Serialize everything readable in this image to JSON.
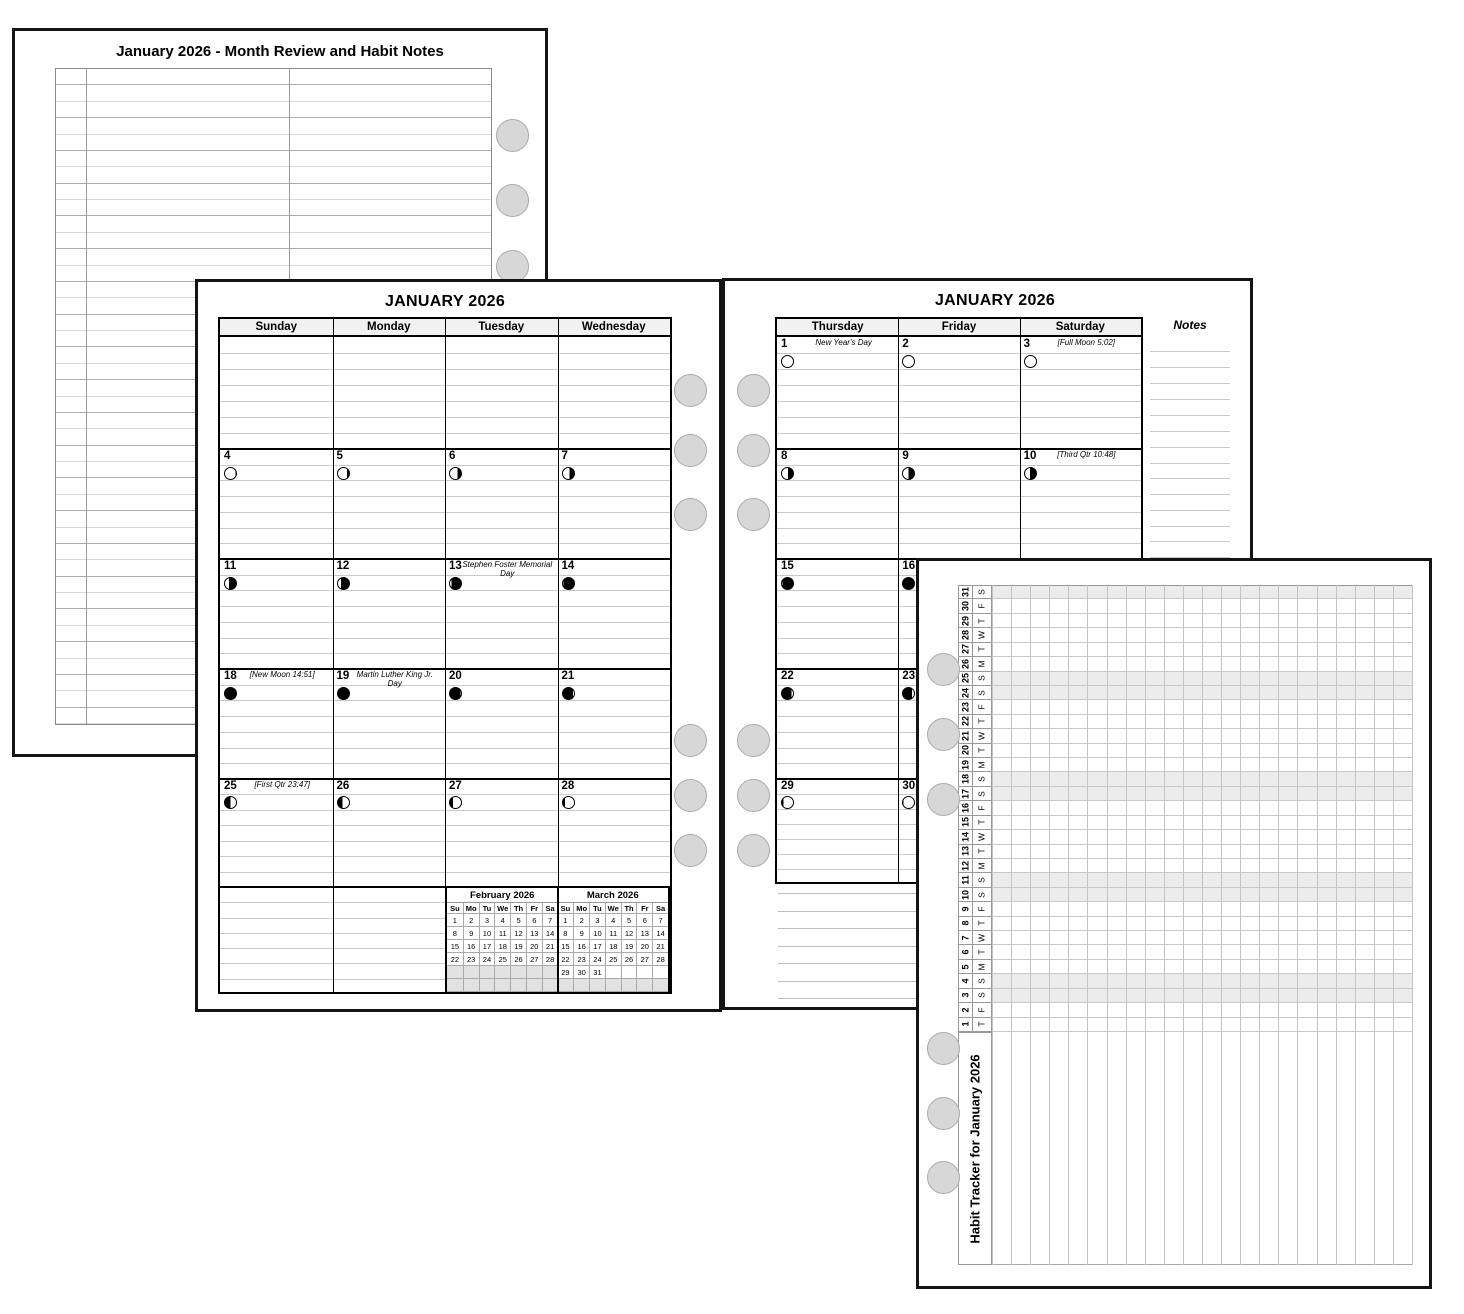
{
  "page_review": {
    "title": "January 2026 - Month Review and Habit Notes"
  },
  "calendar_left": {
    "title": "JANUARY 2026",
    "day_headers": [
      "Sunday",
      "Monday",
      "Tuesday",
      "Wednesday"
    ],
    "weeks": [
      [
        null,
        null,
        null,
        null
      ],
      [
        {
          "num": "4",
          "moon": "r6"
        },
        {
          "num": "5",
          "moon": "r18"
        },
        {
          "num": "6",
          "moon": "r32"
        },
        {
          "num": "7",
          "moon": "r42"
        }
      ],
      [
        {
          "num": "11",
          "moon": "r62"
        },
        {
          "num": "12",
          "moon": "r75"
        },
        {
          "num": "13",
          "moon": "r86",
          "note": "Stephen Foster Memorial Day"
        },
        {
          "num": "14",
          "moon": "r94"
        }
      ],
      [
        {
          "num": "18",
          "moon": "d100",
          "note": "[New Moon 14:51]"
        },
        {
          "num": "19",
          "moon": "d100",
          "note": "Martin Luther King Jr. Day"
        },
        {
          "num": "20",
          "moon": "l97"
        },
        {
          "num": "21",
          "moon": "l92"
        }
      ],
      [
        {
          "num": "25",
          "moon": "l50",
          "note": "[First Qtr 23:47]"
        },
        {
          "num": "26",
          "moon": "l42"
        },
        {
          "num": "27",
          "moon": "l28"
        },
        {
          "num": "28",
          "moon": "l16"
        }
      ]
    ],
    "mini_months": [
      {
        "title": "February 2026",
        "day_names": [
          "Su",
          "Mo",
          "Tu",
          "We",
          "Th",
          "Fr",
          "Sa"
        ],
        "weeks": [
          [
            "1",
            "2",
            "3",
            "4",
            "5",
            "6",
            "7"
          ],
          [
            "8",
            "9",
            "10",
            "11",
            "12",
            "13",
            "14"
          ],
          [
            "15",
            "16",
            "17",
            "18",
            "19",
            "20",
            "21"
          ],
          [
            "22",
            "23",
            "24",
            "25",
            "26",
            "27",
            "28"
          ],
          [
            "",
            "",
            "",
            "",
            "",
            "",
            ""
          ],
          [
            "",
            "",
            "",
            "",
            "",
            "",
            ""
          ]
        ],
        "shaded_week_rows": [
          4,
          5
        ]
      },
      {
        "title": "March 2026",
        "day_names": [
          "Su",
          "Mo",
          "Tu",
          "We",
          "Th",
          "Fr",
          "Sa"
        ],
        "weeks": [
          [
            "1",
            "2",
            "3",
            "4",
            "5",
            "6",
            "7"
          ],
          [
            "8",
            "9",
            "10",
            "11",
            "12",
            "13",
            "14"
          ],
          [
            "15",
            "16",
            "17",
            "18",
            "19",
            "20",
            "21"
          ],
          [
            "22",
            "23",
            "24",
            "25",
            "26",
            "27",
            "28"
          ],
          [
            "29",
            "30",
            "31",
            "",
            "",
            "",
            ""
          ],
          [
            "",
            "",
            "",
            "",
            "",
            "",
            ""
          ]
        ],
        "shaded_week_rows": [
          5
        ]
      }
    ]
  },
  "calendar_right": {
    "title": "JANUARY 2026",
    "day_headers": [
      "Thursday",
      "Friday",
      "Saturday"
    ],
    "notes_label": "Notes",
    "weeks": [
      [
        {
          "num": "1",
          "moon": "d0",
          "note": "New Year's Day"
        },
        {
          "num": "2",
          "moon": "d0"
        },
        {
          "num": "3",
          "moon": "d0",
          "note": "[Full Moon 5:02]"
        }
      ],
      [
        {
          "num": "8",
          "moon": "r46"
        },
        {
          "num": "9",
          "moon": "r52"
        },
        {
          "num": "10",
          "moon": "r55",
          "note": "[Third Qtr 10:48]"
        }
      ],
      [
        {
          "num": "15",
          "moon": "r95"
        },
        {
          "num": "16",
          "moon": "d100"
        },
        {
          "num": "17",
          "moon": "d100"
        }
      ],
      [
        {
          "num": "22",
          "moon": "l88"
        },
        {
          "num": "23",
          "moon": "l82"
        },
        {
          "num": "24",
          "moon": "l75"
        }
      ],
      [
        {
          "num": "29",
          "moon": "l12"
        },
        {
          "num": "30",
          "moon": "l6"
        },
        {
          "num": "31",
          "moon": "l3"
        }
      ]
    ]
  },
  "habit_tracker": {
    "title": "Habit Tracker for January 2026",
    "habit_column_count": 22,
    "days": [
      {
        "num": "31",
        "dow": "S"
      },
      {
        "num": "30",
        "dow": "F"
      },
      {
        "num": "29",
        "dow": "T"
      },
      {
        "num": "28",
        "dow": "W"
      },
      {
        "num": "27",
        "dow": "T"
      },
      {
        "num": "26",
        "dow": "M"
      },
      {
        "num": "25",
        "dow": "S"
      },
      {
        "num": "24",
        "dow": "S"
      },
      {
        "num": "23",
        "dow": "F"
      },
      {
        "num": "22",
        "dow": "T"
      },
      {
        "num": "21",
        "dow": "W"
      },
      {
        "num": "20",
        "dow": "T"
      },
      {
        "num": "19",
        "dow": "M"
      },
      {
        "num": "18",
        "dow": "S"
      },
      {
        "num": "17",
        "dow": "S"
      },
      {
        "num": "16",
        "dow": "F"
      },
      {
        "num": "15",
        "dow": "T"
      },
      {
        "num": "14",
        "dow": "W"
      },
      {
        "num": "13",
        "dow": "T"
      },
      {
        "num": "12",
        "dow": "M"
      },
      {
        "num": "11",
        "dow": "S"
      },
      {
        "num": "10",
        "dow": "S"
      },
      {
        "num": "9",
        "dow": "F"
      },
      {
        "num": "8",
        "dow": "T"
      },
      {
        "num": "7",
        "dow": "W"
      },
      {
        "num": "6",
        "dow": "T"
      },
      {
        "num": "5",
        "dow": "M"
      },
      {
        "num": "4",
        "dow": "S"
      },
      {
        "num": "3",
        "dow": "S"
      },
      {
        "num": "2",
        "dow": "F"
      },
      {
        "num": "1",
        "dow": "T"
      }
    ]
  }
}
